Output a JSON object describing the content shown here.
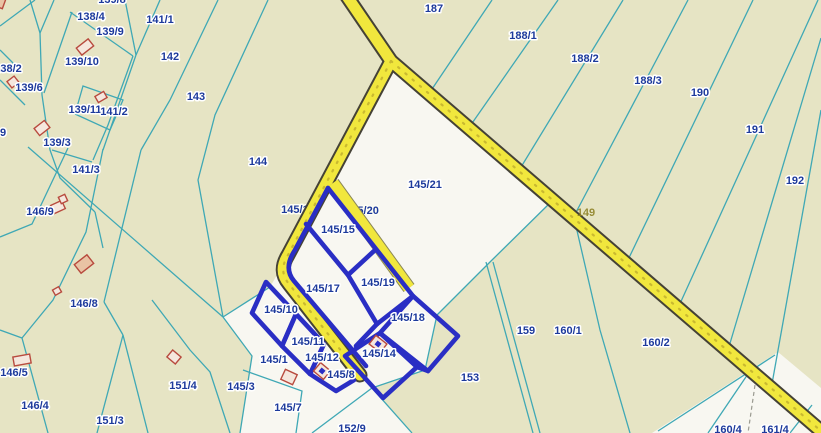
{
  "map": {
    "type": "cadastral-parcel-map",
    "colors": {
      "background_parcel": "#e6e4c4",
      "highlight_area": "#f8f7f1",
      "boundary_line": "#3fa8b5",
      "selected_parcel_border": "#2a2ec4",
      "label_text": "#1d3a9c",
      "road_fill": "#f1e73d",
      "road_casing": "#454236",
      "building_outline": "#b84a3e"
    },
    "labels": [
      {
        "t": "139/8",
        "x": 112,
        "y": 0
      },
      {
        "t": "138/4",
        "x": 91,
        "y": 17
      },
      {
        "t": "139/9",
        "x": 110,
        "y": 32
      },
      {
        "t": "141/1",
        "x": 160,
        "y": 20
      },
      {
        "t": "142",
        "x": 170,
        "y": 57
      },
      {
        "t": "139/10",
        "x": 82,
        "y": 62
      },
      {
        "t": "138/2",
        "x": 8,
        "y": 69
      },
      {
        "t": "139/6",
        "x": 29,
        "y": 88
      },
      {
        "t": "143",
        "x": 196,
        "y": 97
      },
      {
        "t": "139/11",
        "x": 85,
        "y": 110
      },
      {
        "t": "141/2",
        "x": 114,
        "y": 112
      },
      {
        "t": "139/3",
        "x": 57,
        "y": 143
      },
      {
        "t": "9",
        "x": 3,
        "y": 133
      },
      {
        "t": "141/3",
        "x": 86,
        "y": 170
      },
      {
        "t": "144",
        "x": 258,
        "y": 162
      },
      {
        "t": "146/9",
        "x": 40,
        "y": 212
      },
      {
        "t": "146/8",
        "x": 84,
        "y": 304
      },
      {
        "t": "146/5",
        "x": 14,
        "y": 373
      },
      {
        "t": "146/4",
        "x": 35,
        "y": 406
      },
      {
        "t": "151/3",
        "x": 110,
        "y": 421
      },
      {
        "t": "151/4",
        "x": 183,
        "y": 386
      },
      {
        "t": "145/3",
        "x": 241,
        "y": 387
      },
      {
        "t": "187",
        "x": 434,
        "y": 9
      },
      {
        "t": "188/1",
        "x": 523,
        "y": 36
      },
      {
        "t": "188/2",
        "x": 585,
        "y": 59
      },
      {
        "t": "188/3",
        "x": 648,
        "y": 81
      },
      {
        "t": "190",
        "x": 700,
        "y": 93
      },
      {
        "t": "191",
        "x": 755,
        "y": 130
      },
      {
        "t": "192",
        "x": 795,
        "y": 181
      },
      {
        "t": "159",
        "x": 526,
        "y": 331
      },
      {
        "t": "160/1",
        "x": 568,
        "y": 331
      },
      {
        "t": "160/2",
        "x": 656,
        "y": 343
      },
      {
        "t": "153",
        "x": 470,
        "y": 378
      },
      {
        "t": "160/4",
        "x": 728,
        "y": 430
      },
      {
        "t": "161/4",
        "x": 775,
        "y": 430
      },
      {
        "t": "152/9",
        "x": 352,
        "y": 429
      },
      {
        "t": "145/21",
        "x": 425,
        "y": 185
      },
      {
        "t": "145/15",
        "x": 338,
        "y": 230
      },
      {
        "t": "145/17",
        "x": 323,
        "y": 289
      },
      {
        "t": "145/19",
        "x": 378,
        "y": 283
      },
      {
        "t": "145/10",
        "x": 281,
        "y": 310
      },
      {
        "t": "145/18",
        "x": 408,
        "y": 318
      },
      {
        "t": "145/11",
        "x": 308,
        "y": 342
      },
      {
        "t": "145/14",
        "x": 379,
        "y": 354
      },
      {
        "t": "145/1",
        "x": 274,
        "y": 360
      },
      {
        "t": "145/12",
        "x": 322,
        "y": 358
      },
      {
        "t": "145/8",
        "x": 341,
        "y": 375
      },
      {
        "t": "145/7",
        "x": 288,
        "y": 408
      }
    ],
    "under_labels": [
      {
        "t": "145/16",
        "x": 298,
        "y": 210
      },
      {
        "t": "145/20",
        "x": 362,
        "y": 211
      }
    ],
    "road_labels": [
      {
        "t": "149",
        "x": 586,
        "y": 213
      }
    ],
    "buildings": [
      {
        "x": 85,
        "y": 47,
        "w": 15,
        "h": 9,
        "r": -38,
        "style": "outline"
      },
      {
        "x": 13,
        "y": 82,
        "w": 9,
        "h": 8,
        "r": -38,
        "style": "outline"
      },
      {
        "x": 101,
        "y": 97,
        "w": 10,
        "h": 7,
        "r": -30,
        "style": "outline"
      },
      {
        "x": 42,
        "y": 128,
        "w": 13,
        "h": 9,
        "r": -38,
        "style": "outline"
      },
      {
        "x": 58,
        "y": 207,
        "w": 12,
        "h": 9,
        "r": -25,
        "style": "outline"
      },
      {
        "x": 63,
        "y": 199,
        "w": 7,
        "h": 7,
        "r": -25,
        "style": "outline"
      },
      {
        "x": 84,
        "y": 264,
        "w": 16,
        "h": 11,
        "r": -38,
        "style": "salmon"
      },
      {
        "x": 57,
        "y": 291,
        "w": 7,
        "h": 6,
        "r": -30,
        "style": "outline"
      },
      {
        "x": 22,
        "y": 360,
        "w": 17,
        "h": 9,
        "r": -10,
        "style": "outline"
      },
      {
        "x": 174,
        "y": 357,
        "w": 11,
        "h": 9,
        "r": 40,
        "style": "outline"
      },
      {
        "x": 289,
        "y": 377,
        "w": 13,
        "h": 11,
        "r": 25,
        "style": "outline"
      },
      {
        "x": 322,
        "y": 371,
        "w": 13,
        "h": 11,
        "r": 40,
        "style": "outline",
        "marker": true
      },
      {
        "x": 378,
        "y": 344,
        "w": 14,
        "h": 11,
        "r": 38,
        "style": "outline",
        "marker": true
      },
      {
        "x": 0,
        "y": 2,
        "w": 9,
        "h": 11,
        "r": 20,
        "style": "salmon"
      }
    ]
  }
}
